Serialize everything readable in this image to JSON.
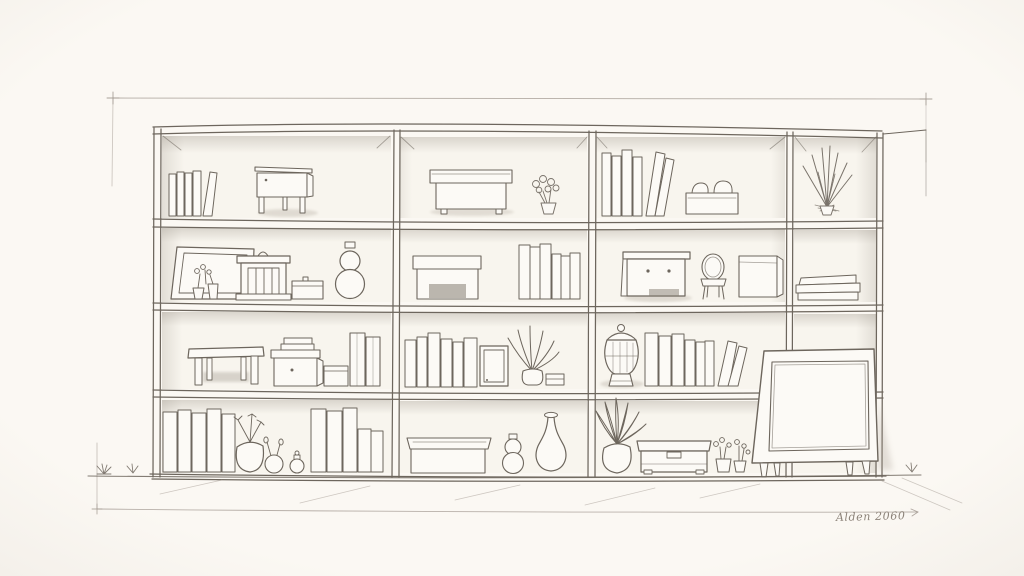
{
  "scene": {
    "medium": "hand-drawn pencil and ink sketch",
    "subject": "wall of open shelving (4 columns x 4 rows) filled with books and decorative objects",
    "signature": "Alden 2060"
  },
  "palette": {
    "paper": "#fbf8f3",
    "ink": "#6d665d",
    "ink_light": "#a19890",
    "cell_shade": "#948c81",
    "object_fill": "#fcfaf6",
    "recess_dark": "#857d72"
  },
  "shelf": {
    "columns": 4,
    "rows": 4,
    "cells": [
      {
        "row": 1,
        "col": 1,
        "items": [
          "leaning-books",
          "side-table"
        ]
      },
      {
        "row": 1,
        "col": 2,
        "items": [
          "lidded-box",
          "flower-sprigs-in-vase"
        ]
      },
      {
        "row": 1,
        "col": 3,
        "items": [
          "books",
          "leaning-books",
          "box-with-cushions"
        ]
      },
      {
        "row": 1,
        "col": 4,
        "items": [
          "spiky-plant"
        ]
      },
      {
        "row": 2,
        "col": 1,
        "items": [
          "leaning-picture-frame",
          "potted-sprigs",
          "shrine-box",
          "lidded-box",
          "gourd-vase"
        ]
      },
      {
        "row": 2,
        "col": 2,
        "items": [
          "box-with-recess",
          "books"
        ]
      },
      {
        "row": 2,
        "col": 3,
        "items": [
          "mini-dresser",
          "chair",
          "cube-box"
        ]
      },
      {
        "row": 2,
        "col": 4,
        "items": [
          "stacked-books"
        ]
      },
      {
        "row": 3,
        "col": 1,
        "items": [
          "stool",
          "box-with-lid-stack",
          "small-box",
          "tall-slabs"
        ]
      },
      {
        "row": 3,
        "col": 2,
        "items": [
          "books",
          "small-frame",
          "potted-palm",
          "small-stack"
        ]
      },
      {
        "row": 3,
        "col": 3,
        "items": [
          "lidded-urn",
          "books",
          "leaning-books"
        ]
      },
      {
        "row": 3,
        "col": 4,
        "items": [
          "tv-cabinet-front"
        ]
      },
      {
        "row": 4,
        "col": 1,
        "items": [
          "books",
          "potted-plant",
          "bud-vase",
          "small-jar",
          "books"
        ]
      },
      {
        "row": 4,
        "col": 2,
        "items": [
          "lidded-tray",
          "gourd-vase",
          "bottle-vase"
        ]
      },
      {
        "row": 4,
        "col": 3,
        "items": [
          "broad-leaf-plant",
          "storage-chest",
          "flower-pots"
        ]
      },
      {
        "row": 4,
        "col": 4,
        "items": [
          "tv-cabinet-legs"
        ]
      }
    ]
  },
  "floor": {
    "grass_tufts": 3,
    "hatch_lines": true,
    "arrow_line": true
  },
  "border": {
    "style": "light construction frame with corner tick crosses"
  }
}
